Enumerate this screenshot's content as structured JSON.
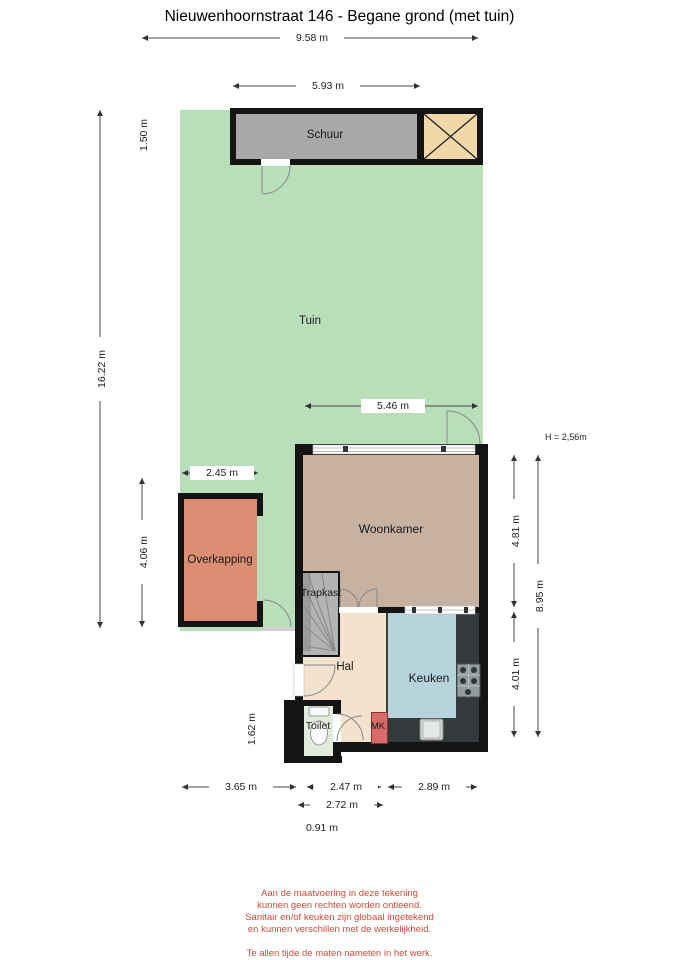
{
  "title": "Nieuwenhoornstraat 146 - Begane grond (met tuin)",
  "rooms": {
    "schuur": "Schuur",
    "tuin": "Tuin",
    "overkapping": "Overkapping",
    "woonkamer": "Woonkamer",
    "trapkast": "Trapkast",
    "hal": "Hal",
    "keuken": "Keuken",
    "toilet": "Toilet",
    "mk": "MK"
  },
  "dimensions": {
    "plot_width": "9.58 m",
    "schuur_width": "5.93 m",
    "schuur_depth": "1.50 m",
    "plot_depth": "16.22 m",
    "woonkamer_width": "5.46 m",
    "overkapping_width": "2.45 m",
    "overkapping_depth": "4.06 m",
    "woonkamer_depth": "4.81 m",
    "house_depth": "8.95 m",
    "keuken_depth": "4.01 m",
    "toilet_depth": "1.62 m",
    "bottom_left": "3.65 m",
    "bottom_mid": "2.47 m",
    "bottom_right": "2.89 m",
    "bottom_mid2": "2.72 m",
    "bottom_small": "0.91 m"
  },
  "height_note": "H = 2,56m",
  "footer": {
    "disclaimer": [
      "Aan de maatvoering in deze tekening",
      "kunnen geen rechten worden ontleend.",
      "Sanitair en/of keuken zijn globaal ingetekend",
      "en kunnen verschillen met de werkelijkheid."
    ],
    "note": [
      "Te allen tijde de maten nameten in het werk.",
      "© Zuidstad Makelaars B.V."
    ]
  },
  "colors": {
    "tuin": "#b9dfba",
    "woonkamer": "#c7b1a1",
    "hal": "#f3e2cd",
    "keuken": "#b7d4dc",
    "overkapping": "#dc8e72",
    "schuur": "#a8a8a8",
    "storage_box": "#f2d8a8",
    "counter": "#34393b",
    "mk": "#d96a6a",
    "toilet": "#e3ebdf",
    "trapkast": "#b3b3b3",
    "wall": "#141414",
    "disclaimer_text": "#cf4a38"
  }
}
